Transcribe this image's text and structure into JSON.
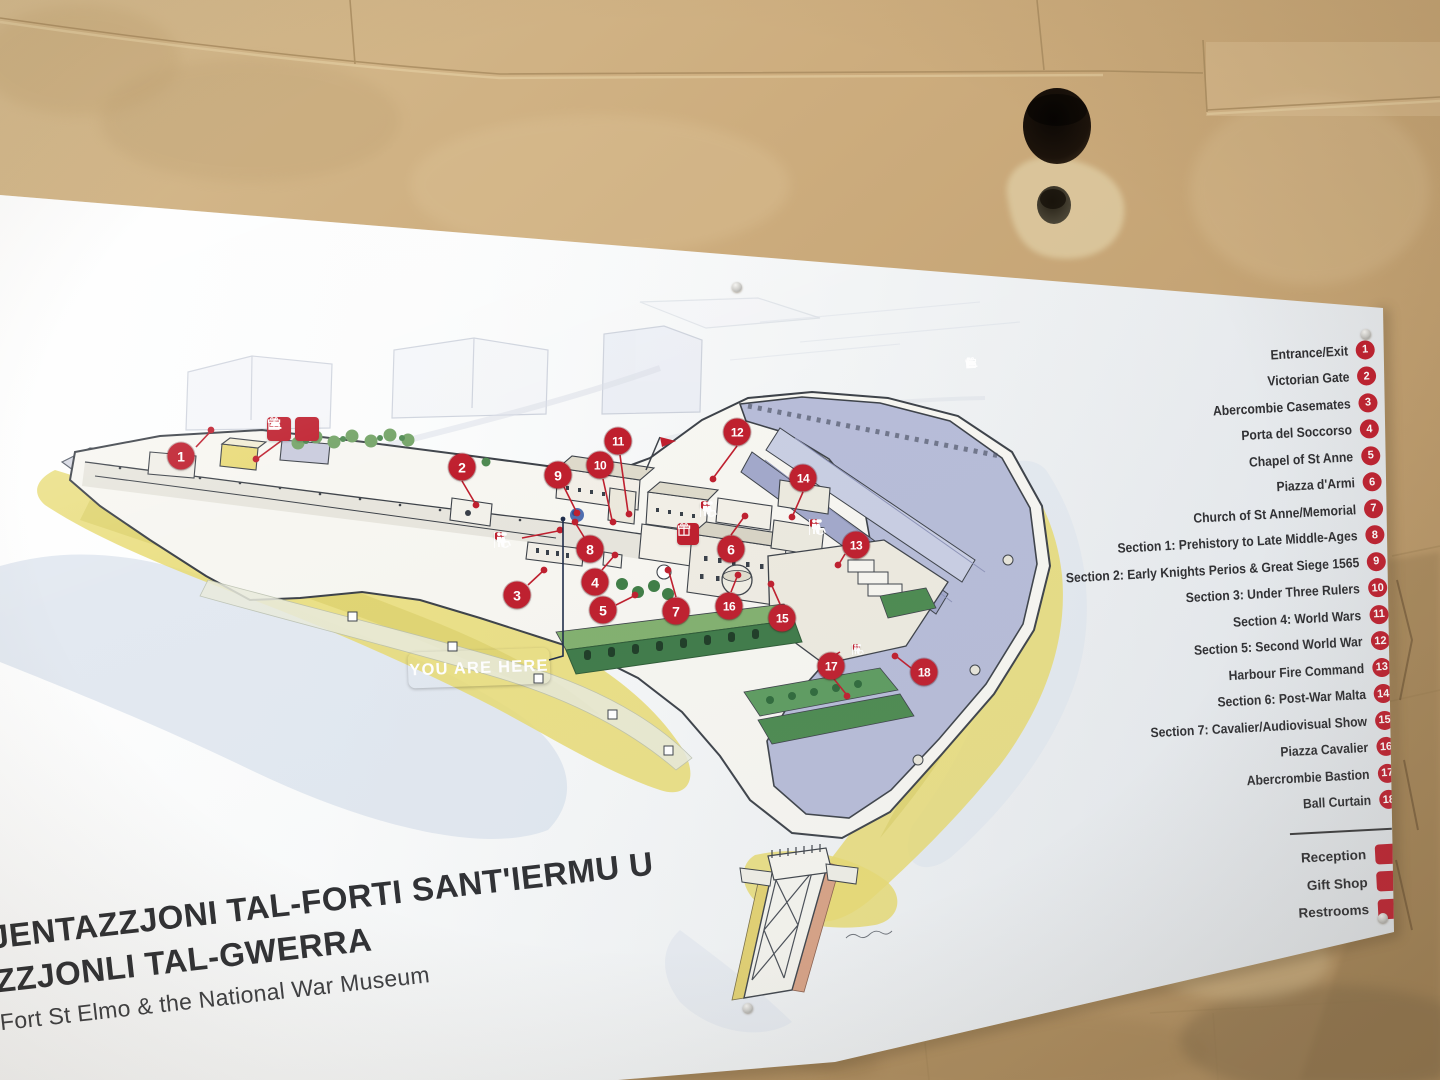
{
  "panel": {
    "you_are_here": "YOU ARE HERE",
    "title": {
      "line1": "JENTAZZJONI TAL-FORTI SANT'IERMU U",
      "line2": "ZZJONLI TAL-GWERRA",
      "subtitle": "Fort St Elmo & the National War Museum"
    },
    "legend": {
      "items": [
        {
          "n": "1",
          "label": "Entrance/Exit"
        },
        {
          "n": "2",
          "label": "Victorian Gate"
        },
        {
          "n": "3",
          "label": "Abercombie Casemates"
        },
        {
          "n": "4",
          "label": "Porta del Soccorso"
        },
        {
          "n": "5",
          "label": "Chapel of St Anne"
        },
        {
          "n": "6",
          "label": "Piazza d'Armi"
        },
        {
          "n": "7",
          "label": "Church of St Anne/Memorial"
        },
        {
          "n": "8",
          "label": "Section 1: Prehistory to Late Middle-Ages"
        },
        {
          "n": "9",
          "label": "Section 2: Early Knights Perios & Great Siege 1565"
        },
        {
          "n": "10",
          "label": "Section 3: Under Three Rulers"
        },
        {
          "n": "11",
          "label": "Section 4: World Wars"
        },
        {
          "n": "12",
          "label": "Section 5: Second World War"
        },
        {
          "n": "13",
          "label": "Harbour Fire Command"
        },
        {
          "n": "14",
          "label": "Section 6: Post-War Malta"
        },
        {
          "n": "15",
          "label": "Section 7: Cavalier/Audiovisual Show"
        },
        {
          "n": "16",
          "label": "Piazza Cavalier"
        },
        {
          "n": "17",
          "label": "Abercrombie Bastion"
        },
        {
          "n": "18",
          "label": "Ball Curtain"
        }
      ],
      "facilities": [
        {
          "icon": "reception",
          "label": "Reception"
        },
        {
          "icon": "gift",
          "label": "Gift Shop"
        },
        {
          "icon": "restrooms",
          "label": "Restrooms"
        }
      ]
    },
    "map": {
      "markers": [
        {
          "n": "1",
          "x": 181,
          "y": 456
        },
        {
          "n": "2",
          "x": 462,
          "y": 467
        },
        {
          "n": "3",
          "x": 517,
          "y": 595
        },
        {
          "n": "4",
          "x": 595,
          "y": 582
        },
        {
          "n": "5",
          "x": 603,
          "y": 610
        },
        {
          "n": "6",
          "x": 731,
          "y": 549
        },
        {
          "n": "7",
          "x": 676,
          "y": 611
        },
        {
          "n": "8",
          "x": 590,
          "y": 549
        },
        {
          "n": "9",
          "x": 558,
          "y": 475
        },
        {
          "n": "10",
          "x": 600,
          "y": 465
        },
        {
          "n": "11",
          "x": 618,
          "y": 441
        },
        {
          "n": "12",
          "x": 737,
          "y": 432
        },
        {
          "n": "13",
          "x": 856,
          "y": 545
        },
        {
          "n": "14",
          "x": 803,
          "y": 478
        },
        {
          "n": "15",
          "x": 782,
          "y": 618
        },
        {
          "n": "16",
          "x": 729,
          "y": 606
        },
        {
          "n": "17",
          "x": 831,
          "y": 666
        },
        {
          "n": "18",
          "x": 924,
          "y": 672
        }
      ],
      "badges": [
        {
          "type": "reception_gift",
          "x": 293,
          "y": 429
        },
        {
          "type": "wc",
          "x": 499,
          "y": 536
        },
        {
          "type": "wc",
          "x": 705,
          "y": 505
        },
        {
          "type": "gift",
          "x": 688,
          "y": 534
        },
        {
          "type": "wc",
          "x": 814,
          "y": 523
        },
        {
          "type": "wc_small",
          "x": 856,
          "y": 647
        }
      ]
    }
  },
  "colors": {
    "marker_red": "#bf1f2e",
    "you_are_here_blue": "#1c3e92",
    "wall_tan": "#c9a97a",
    "legend_text": "#2d2d30"
  }
}
